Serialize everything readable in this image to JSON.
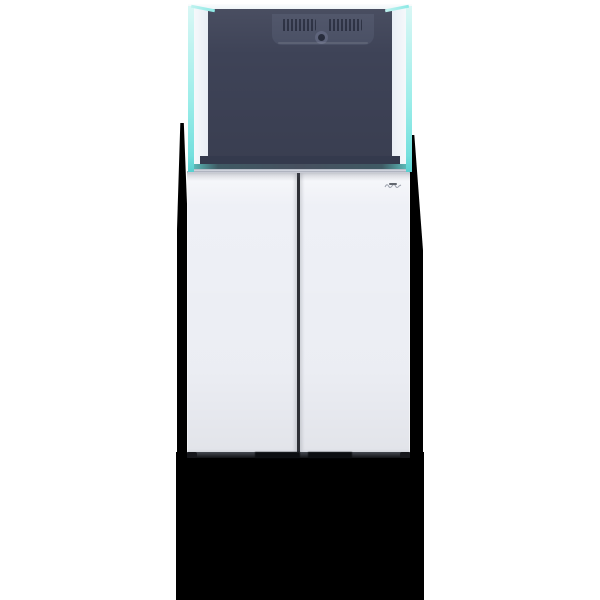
{
  "scene": {
    "alt": "Rimless glass aquarium with rear overflow box sitting on a white handleless two-door cabinet stand, hard black drop shadow beneath and beside the stand",
    "background_color": "#ffffff",
    "shadow_color": "#000000"
  },
  "tank": {
    "interior_color": "#3e4357",
    "glass_edge_color": "#8ce9e5",
    "glass_edge_highlight": "#d9f7f5",
    "side_panel_color": "#eff2f8",
    "overflow_box_color": "#484e63",
    "grille_slat_color": "#262b3d",
    "hole_ring_color": "#5a6078",
    "hole_core_color": "#232838",
    "lower_band_color": "#343a4d",
    "water_band_color": "#47505f",
    "water_band_glow": "#5cc0bd"
  },
  "cabinet": {
    "door_color": "#eef0f6",
    "seam_color": "#2e3036",
    "base_color": "#2f3238",
    "base_dark_color": "#0c0e11",
    "base_cap_color": "#16171b",
    "logo_mark_color": "#8d93a0",
    "logo_sub_color": "#4a4f58"
  }
}
